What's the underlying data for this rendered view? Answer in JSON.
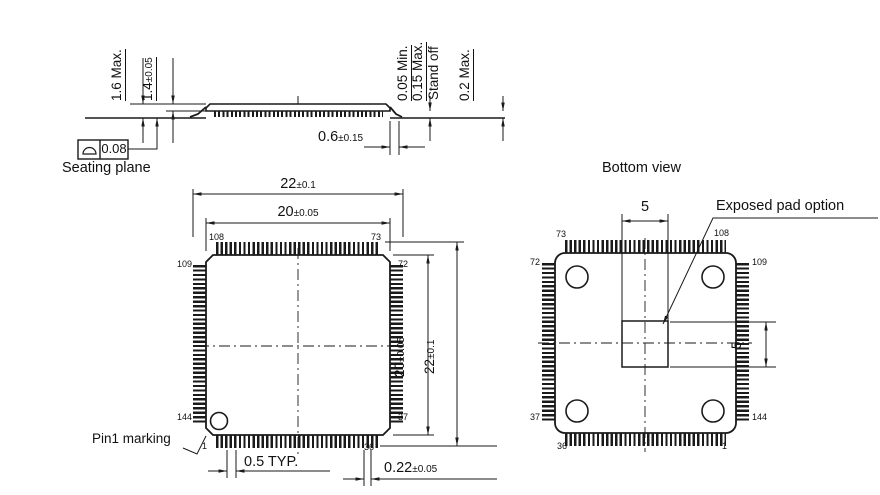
{
  "drawing": {
    "colors": {
      "line": "#1a1a1a",
      "background": "#ffffff"
    },
    "side_view": {
      "height_max": "1.6 Max.",
      "body_thickness": {
        "val": "1.4",
        "tol": "±0.05"
      },
      "standoff_min": "0.05 Min.",
      "standoff_max": "0.15 Max.",
      "standoff_label": "Stand off",
      "lead_thickness": "0.2 Max.",
      "foot_length": {
        "val": "0.6",
        "tol": "±0.15"
      },
      "seating_tolerance": "0.08",
      "seating_label": "Seating plane"
    },
    "top_view": {
      "overall_width": {
        "val": "22",
        "tol": "±0.1"
      },
      "body_width": {
        "val": "20",
        "tol": "±0.05"
      },
      "body_height": {
        "val": "20",
        "tol": "±0.05"
      },
      "overall_height": {
        "val": "22",
        "tol": "±0.1"
      },
      "lead_pitch": "0.5 TYP.",
      "lead_width": {
        "val": "0.22",
        "tol": "±0.05"
      },
      "pin1_label": "Pin1 marking",
      "pin_labels": {
        "top_left": "108",
        "top_right": "73",
        "left_top": "109",
        "right_top": "72",
        "left_bottom": "144",
        "right_bottom": "37",
        "bottom_left": "1",
        "bottom_right": "36"
      }
    },
    "bottom_view": {
      "title": "Bottom view",
      "exposed_pad_label": "Exposed pad option",
      "pad_width": "5",
      "pad_height": "5",
      "pin_labels": {
        "top_left": "73",
        "top_right": "108",
        "left_top": "72",
        "right_top": "109",
        "left_bottom": "37",
        "right_bottom": "144",
        "bottom_left": "36",
        "bottom_right": "1"
      }
    }
  }
}
